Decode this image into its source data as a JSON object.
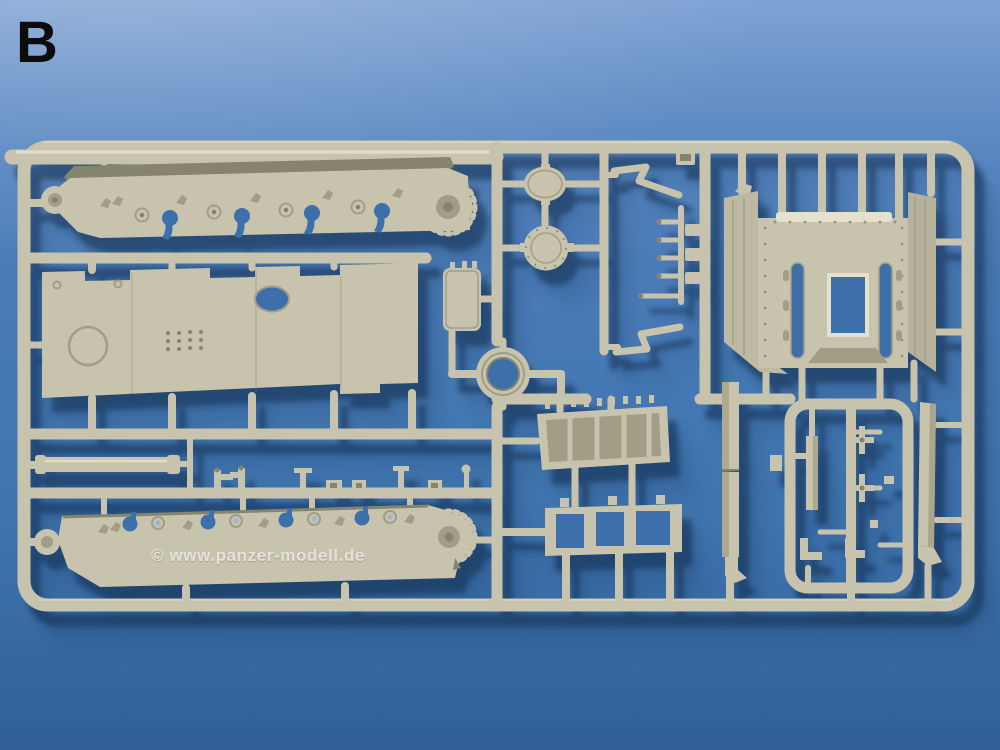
{
  "scene": {
    "type": "photograph",
    "subject": "Injection-molded model kit sprue (frame B) with tank hull parts on a blue background",
    "sprue_letter": "B",
    "watermark": "© www.panzer-modell.de"
  },
  "colors": {
    "background_top": "#7fa2d4",
    "background_mid": "#4478b3",
    "background_bottom": "#2f5f94",
    "plastic_base": "#c7c3ac",
    "plastic_highlight": "#e4e1cf",
    "plastic_shadow": "#a29e86",
    "plastic_dark": "#87846d",
    "hole_blue": "#3d70aa",
    "cast_shadow": "#0c2646",
    "letter_color": "#0c0c0c",
    "watermark_color": "rgba(242,242,236,0.80)"
  },
  "parts": [
    {
      "name": "hull-side-upper",
      "desc": "long hull side panel with wheel openings and toothed drive sprocket"
    },
    {
      "name": "hull-roof-panel",
      "desc": "large flat hull plate with notched edges and oval opening"
    },
    {
      "name": "access-panel-small",
      "desc": "small rounded rectangular panel"
    },
    {
      "name": "turret-ring",
      "desc": "circular ring part"
    },
    {
      "name": "oval-hatch",
      "desc": "small oval hatch"
    },
    {
      "name": "round-hatch",
      "desc": "round riveted hatch"
    },
    {
      "name": "z-bracket-top",
      "desc": "angled Z-shaped bracket"
    },
    {
      "name": "z-bracket-bottom",
      "desc": "angled Z-shaped bracket (mirror)"
    },
    {
      "name": "ladder-small-parts",
      "desc": "column of small rungs and blocks"
    },
    {
      "name": "rear-plate-assembly",
      "desc": "rear hull plate with two slots, central opening and angled side wings"
    },
    {
      "name": "engine-grille",
      "desc": "louvered engine grille panel"
    },
    {
      "name": "open-frame-part",
      "desc": "open rectangular frame with two cross bars"
    },
    {
      "name": "gun-cylinder",
      "desc": "long cylindrical part"
    },
    {
      "name": "small-parts-row",
      "desc": "row of tiny fittings on a runner"
    },
    {
      "name": "hull-side-lower",
      "desc": "second hull side panel with toothed sprocket"
    },
    {
      "name": "skirt-strip-left",
      "desc": "long vertical strip part"
    },
    {
      "name": "skirt-strip-right",
      "desc": "long vertical strip part with foot"
    },
    {
      "name": "right-parts-cluster",
      "desc": "cluster of small axles, strips and brackets in inner frame"
    }
  ]
}
